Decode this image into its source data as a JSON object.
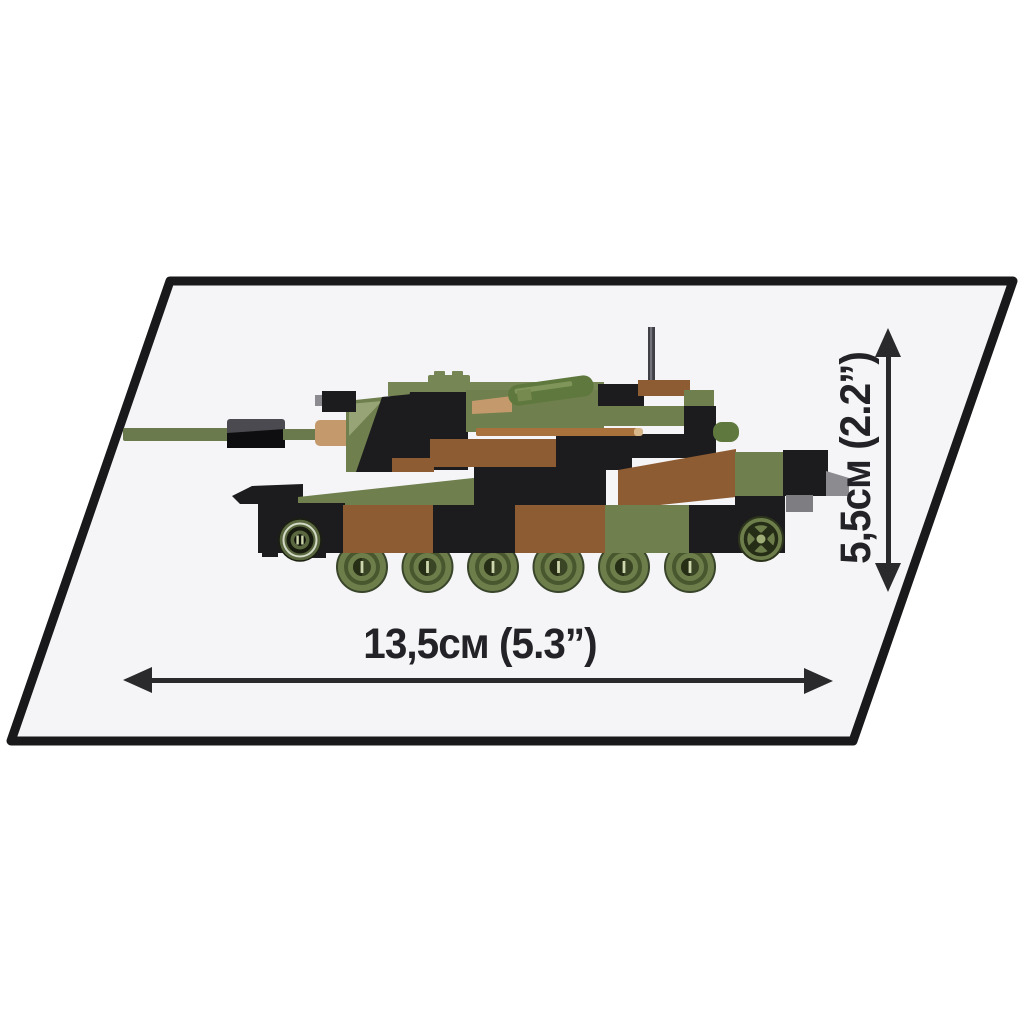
{
  "scene": {
    "description": "Brick-built camouflage tank model displayed on a tilted white board with printed size dimension arrows",
    "background": "#ffffff"
  },
  "labels": {
    "width": "13,5см (5.3”)",
    "height": "5,5см (2.2”)"
  },
  "icons": {
    "width_arrow": "double-headed-horizontal-arrow",
    "height_arrow": "double-headed-vertical-arrow"
  },
  "colors": {
    "platform_fill": "#f5f5f7",
    "platform_border": "#19191b",
    "arrow": "#2a2a2d",
    "label_text": "#232327",
    "camo_green": "#6f7f4e",
    "camo_green_top": "#778655",
    "camo_green_light": "#96a476",
    "camo_dark_green": "#5e783d",
    "camo_brown": "#8e5c33",
    "camo_black": "#1c1c1e",
    "barrel_green": "#6b7a4d",
    "muzzle_gray": "#4a4a50",
    "tan": "#c49a6c",
    "copper_stripe": "#a9713c",
    "detail_gray": "#8b8b90",
    "detail_gray_dark": "#7d7d82",
    "antenna": "#3f3f45",
    "wheel_green": "#6e7e4b",
    "wheel_ring": "#49572f",
    "wheel_hub": "#394524",
    "wheel_hub_dark": "#272e16",
    "idler_green": "#5a6840",
    "idler_dark": "#171a0e",
    "hub_light": "#9fae76",
    "wheel_mark": "#ccd5ab"
  }
}
